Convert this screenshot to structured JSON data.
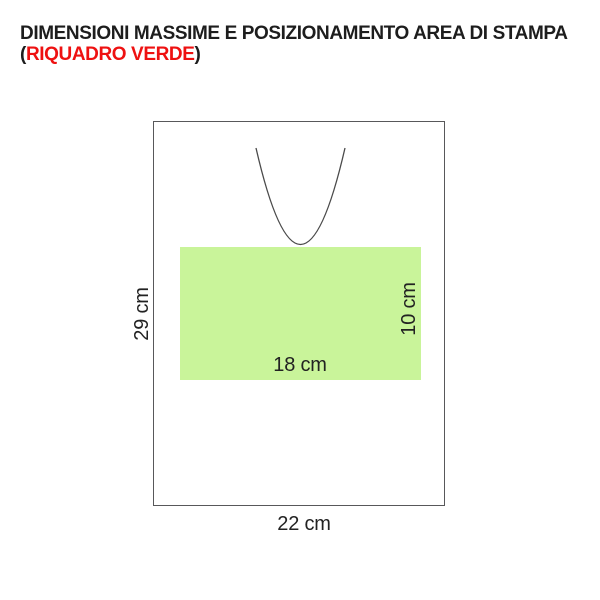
{
  "title": {
    "line1": "DIMENSIONI MASSIME E POSIZIONAMENTO AREA DI STAMPA",
    "line2_prefix": "(",
    "line2_highlight": "RIQUADRO VERDE",
    "line2_suffix": ")",
    "highlight_color": "#ee1111",
    "text_color": "#1d1d1d"
  },
  "diagram": {
    "outline_color": "#58585a",
    "print_area_fill": "#c9f49a",
    "labels": {
      "bag_height": "29 cm",
      "bag_width": "22 cm",
      "print_width": "18 cm",
      "print_height": "10 cm"
    }
  }
}
